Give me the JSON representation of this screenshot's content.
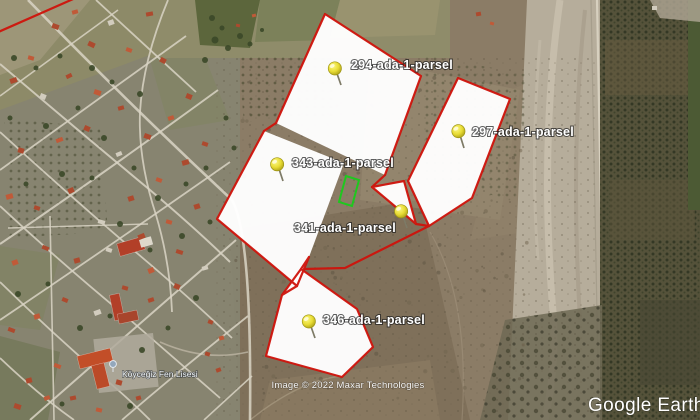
{
  "app": {
    "logo_text": "Google Earth"
  },
  "attribution": {
    "imagery_credit": "Image © 2022 Maxar Technologies"
  },
  "map": {
    "parcels": [
      {
        "id": "294-ada-1",
        "label": "294-ada-1-parsel"
      },
      {
        "id": "297-ada-1",
        "label": "297-ada-1-parsel"
      },
      {
        "id": "343-ada-1",
        "label": "343-ada-1-parsel"
      },
      {
        "id": "341-ada-1",
        "label": "341-ada-1-parsel"
      },
      {
        "id": "346-ada-1",
        "label": "346-ada-1-parsel"
      }
    ],
    "place_labels": [
      {
        "name": "Köyceğiz Fen Lisesi",
        "type": "school"
      }
    ],
    "colors": {
      "parcel_fill": "#ffffff",
      "parcel_border": "#cf130b",
      "highlight_border": "#1ec81e",
      "pin": "#e8dc34"
    }
  }
}
